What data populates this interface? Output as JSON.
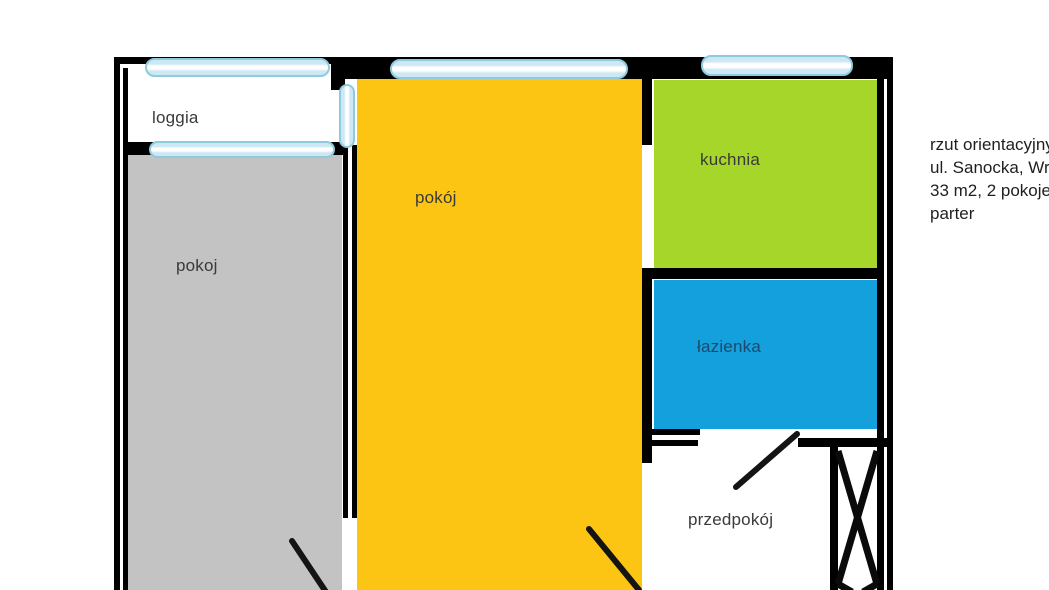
{
  "title": "apartment floor plan sketch",
  "rooms": [
    {
      "id": "loggia",
      "label": "loggia",
      "color": "#FFFFFF"
    },
    {
      "id": "pokoj-left",
      "label": "pokoj",
      "color": "#C3C3C3"
    },
    {
      "id": "pokoj-main",
      "label": "pokój",
      "color": "#FDC513"
    },
    {
      "id": "kuchnia",
      "label": "kuchnia",
      "color": "#A6D629"
    },
    {
      "id": "lazienka",
      "label": "łazienka",
      "color": "#14A0DC"
    },
    {
      "id": "przedpokoj",
      "label": "przedpokój",
      "color": "#FFFFFF"
    }
  ],
  "info_panel": {
    "lines": [
      "rzut orientacyjny",
      "ul. Sanocka, Wro",
      "33 m2, 2 pokoje",
      "parter"
    ]
  },
  "colors": {
    "wall": "#000000",
    "window_fill": "#CDE8F2",
    "window_border": "#8FCBDE",
    "door_line": "#141414"
  }
}
